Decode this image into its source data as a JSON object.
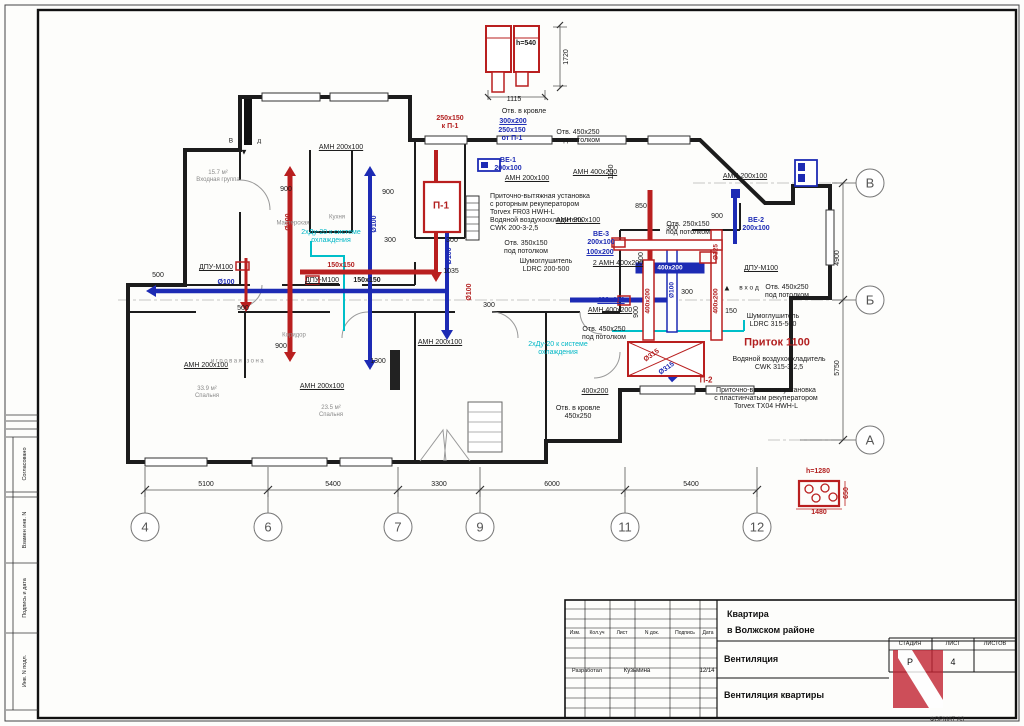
{
  "colors": {
    "black": "#1a1a1a",
    "red": "#b21f1f",
    "blue": "#1d2bb4",
    "cyan": "#00b7c6",
    "gray": "#8a8a8a",
    "white": "#ffffff"
  },
  "sheet": {
    "format_label": "ФОРМАТ А3"
  },
  "stamp_left": [
    {
      "t": "Согласовано",
      "y": 464
    },
    {
      "t": "Взамен инв. N",
      "y": 530
    },
    {
      "t": "Подпись и дата",
      "y": 598
    },
    {
      "t": "Инв. N подл.",
      "y": 671
    }
  ],
  "titleblock": {
    "columns": [
      "Изм.",
      "Кол.уч",
      "Лист",
      "N док.",
      "Подпись",
      "Дата"
    ],
    "row_role": "Разработал",
    "row_name": "Кузьмина",
    "row_date": "12/14",
    "project_line1": "Квартира",
    "project_line2": "в Волжском районе",
    "section": "Вентиляция",
    "drawing": "Вентиляция квартиры",
    "stage_header": "СТАДИЯ",
    "sheet_header": "ЛИСТ",
    "sheets_header": "ЛИСТОВ",
    "stage_value": "Р",
    "sheet_value": "4"
  },
  "axes_bottom": [
    {
      "label": "4",
      "x": 145
    },
    {
      "label": "6",
      "x": 268
    },
    {
      "label": "7",
      "x": 398
    },
    {
      "label": "9",
      "x": 480
    },
    {
      "label": "11",
      "x": 625
    },
    {
      "label": "12",
      "x": 757
    }
  ],
  "axes_right": [
    {
      "label": "В",
      "y": 183
    },
    {
      "label": "Б",
      "y": 300
    },
    {
      "label": "А",
      "y": 440
    }
  ],
  "dims_bottom": [
    {
      "t": "5100",
      "x": 206
    },
    {
      "t": "5400",
      "x": 333
    },
    {
      "t": "3300",
      "x": 439
    },
    {
      "t": "6000",
      "x": 552
    },
    {
      "t": "5400",
      "x": 691
    }
  ],
  "dims_right": [
    {
      "t": "4900",
      "y": 258
    },
    {
      "t": "5750",
      "y": 368
    }
  ],
  "labels": [
    {
      "t": "h=540",
      "x": 526,
      "y": 44,
      "b": 1
    },
    {
      "t": "1720",
      "x": 567,
      "y": 57,
      "r": -90
    },
    {
      "t": "1115",
      "x": 514,
      "y": 100
    },
    {
      "t": "250x150\nк П-1",
      "x": 450,
      "y": 123,
      "c": "red",
      "b": 1
    },
    {
      "t": "Отв. в кровле",
      "x": 524,
      "y": 112
    },
    {
      "t": "300x200",
      "x": 513,
      "y": 122,
      "c": "blue",
      "b": 1,
      "u": 1
    },
    {
      "t": "250x150\nот П-1",
      "x": 512,
      "y": 135,
      "c": "blue",
      "b": 1
    },
    {
      "t": "Отв. 450x250\nпод потолком",
      "x": 578,
      "y": 137
    },
    {
      "t": "АМН 200х100",
      "x": 341,
      "y": 148,
      "u": 1
    },
    {
      "t": "ВЕ-1\n200x100",
      "x": 508,
      "y": 165,
      "c": "blue",
      "b": 1,
      "n": "ve1-label"
    },
    {
      "t": "АМН 200х100",
      "x": 527,
      "y": 179,
      "u": 1
    },
    {
      "t": "АМН 400х200",
      "x": 595,
      "y": 173,
      "u": 1
    },
    {
      "t": "1150",
      "x": 612,
      "y": 172,
      "r": -90
    },
    {
      "t": "Приточно-вытяжная установка\nс роторным рекуператором\nTorvex FR03 HWH-L\nВодяной воздухоохладитель\nCWK 200-3-2,5",
      "x": 540,
      "y": 213,
      "a": "left",
      "n": "ahu1-note"
    },
    {
      "t": "П-1",
      "x": 441,
      "y": 206,
      "c": "red",
      "b": 1,
      "s": 10,
      "n": "unit-p1-label"
    },
    {
      "t": "Отв. 350x150\nпод потолком",
      "x": 526,
      "y": 248
    },
    {
      "t": "Шумоглушитель\nLDRC 200-500",
      "x": 546,
      "y": 266
    },
    {
      "t": "ВЕ-3\n200x100",
      "x": 601,
      "y": 239,
      "c": "blue",
      "b": 1,
      "n": "ve3-label"
    },
    {
      "t": "100x200",
      "x": 600,
      "y": 253,
      "c": "blue",
      "b": 1,
      "u": 1
    },
    {
      "t": "2 АМН 400х200",
      "x": 618,
      "y": 264,
      "u": 1
    },
    {
      "t": "400x100",
      "x": 611,
      "y": 301,
      "c": "blue",
      "b": 1,
      "u": 1
    },
    {
      "t": "АМН 400х200",
      "x": 610,
      "y": 311,
      "u": 1
    },
    {
      "t": "Отв. 450x250\nпод потолком",
      "x": 604,
      "y": 334
    },
    {
      "t": "2хДу-20 к системе\nохлаждения",
      "x": 558,
      "y": 349,
      "c": "cyan"
    },
    {
      "t": "2хДу-20 к системе\nохлаждения",
      "x": 331,
      "y": 237,
      "c": "cyan"
    },
    {
      "t": "АМН 200х100",
      "x": 745,
      "y": 177,
      "u": 1
    },
    {
      "t": "Отв. 250x150\nпод потолком",
      "x": 688,
      "y": 229
    },
    {
      "t": "ВЕ-2\n200x100",
      "x": 756,
      "y": 225,
      "c": "blue",
      "b": 1,
      "n": "ve2-label"
    },
    {
      "t": "ДПУ-М100",
      "x": 761,
      "y": 269,
      "u": 1
    },
    {
      "t": "▲",
      "x": 727,
      "y": 288,
      "s": 8
    },
    {
      "t": "в х о д",
      "x": 749,
      "y": 288,
      "s": 6.5
    },
    {
      "t": "Отв. 450x250\nпод потолком",
      "x": 787,
      "y": 292
    },
    {
      "t": "Шумоглушитель\nLDRC 315-500",
      "x": 773,
      "y": 321
    },
    {
      "t": "Приток 1100",
      "x": 777,
      "y": 343,
      "c": "red",
      "b": 1,
      "s": 11,
      "n": "pritok-label"
    },
    {
      "t": "Водяной воздухоохладитель\nCWK 315-3-2,5",
      "x": 779,
      "y": 364
    },
    {
      "t": "Приточно-вытяжная установка\nс пластинчатым рекуператором\nTorvex TX04 HWH-L",
      "x": 766,
      "y": 399,
      "n": "ahu2-note"
    },
    {
      "t": "400x200",
      "x": 595,
      "y": 392,
      "u": 1
    },
    {
      "t": "Отв. в кровле\n450x250",
      "x": 578,
      "y": 413
    },
    {
      "t": "Ø315",
      "x": 652,
      "y": 356,
      "c": "red",
      "b": 1,
      "r": -35
    },
    {
      "t": "Ø315",
      "x": 667,
      "y": 369,
      "c": "blue",
      "b": 1,
      "r": -35
    },
    {
      "t": "П-2",
      "x": 706,
      "y": 380,
      "c": "red",
      "b": 1,
      "s": 8,
      "n": "unit-p2-label"
    },
    {
      "t": "400x200",
      "x": 670,
      "y": 268,
      "c": "white",
      "b": 1,
      "s": 6.5
    },
    {
      "t": "400x200",
      "x": 648,
      "y": 301,
      "c": "red",
      "b": 1,
      "r": -90,
      "s": 6.5
    },
    {
      "t": "400x200",
      "x": 716,
      "y": 301,
      "c": "red",
      "b": 1,
      "r": -90,
      "s": 6.5
    },
    {
      "t": "Ø125",
      "x": 716,
      "y": 252,
      "c": "red",
      "b": 1,
      "r": -90,
      "s": 6.5
    },
    {
      "t": "Ø100",
      "x": 672,
      "y": 290,
      "c": "blue",
      "b": 1,
      "r": -90,
      "s": 6.5
    },
    {
      "t": "ДПУ-М100",
      "x": 216,
      "y": 268,
      "u": 1
    },
    {
      "t": "ДПУ-М100",
      "x": 322,
      "y": 281,
      "u": 1
    },
    {
      "t": "150x150",
      "x": 341,
      "y": 266,
      "c": "red",
      "b": 1
    },
    {
      "t": "150x150",
      "x": 367,
      "y": 281,
      "b": 1
    },
    {
      "t": "Ø100",
      "x": 226,
      "y": 283,
      "c": "blue",
      "b": 1
    },
    {
      "t": "Ø100",
      "x": 289,
      "y": 222,
      "c": "red",
      "b": 1,
      "r": -90
    },
    {
      "t": "Ø100",
      "x": 375,
      "y": 224,
      "c": "blue",
      "b": 1,
      "r": -90
    },
    {
      "t": "Ø100",
      "x": 450,
      "y": 256,
      "c": "blue",
      "b": 1,
      "r": -90
    },
    {
      "t": "Ø100",
      "x": 470,
      "y": 292,
      "c": "red",
      "b": 1,
      "r": -90
    },
    {
      "t": "АМН 200х100",
      "x": 206,
      "y": 366,
      "u": 1
    },
    {
      "t": "АМН 200х100",
      "x": 322,
      "y": 387,
      "u": 1
    },
    {
      "t": "АМН 200х100",
      "x": 440,
      "y": 343,
      "u": 1
    },
    {
      "t": "АМН 200х100",
      "x": 578,
      "y": 221,
      "u": 1
    },
    {
      "t": "В х о д",
      "x": 246,
      "y": 141,
      "s": 6.5,
      "ls": "2px"
    },
    {
      "t": "▼",
      "x": 244,
      "y": 152,
      "s": 8
    },
    {
      "t": "500",
      "x": 158,
      "y": 276
    },
    {
      "t": "500",
      "x": 243,
      "y": 309
    },
    {
      "t": "900",
      "x": 286,
      "y": 190
    },
    {
      "t": "900",
      "x": 388,
      "y": 193
    },
    {
      "t": "300",
      "x": 390,
      "y": 241
    },
    {
      "t": "300",
      "x": 452,
      "y": 241
    },
    {
      "t": "1035",
      "x": 451,
      "y": 272
    },
    {
      "t": "300",
      "x": 489,
      "y": 306
    },
    {
      "t": "900",
      "x": 281,
      "y": 347
    },
    {
      "t": "1300",
      "x": 378,
      "y": 362
    },
    {
      "t": "850",
      "x": 641,
      "y": 207
    },
    {
      "t": "100",
      "x": 642,
      "y": 258,
      "r": -90
    },
    {
      "t": "900",
      "x": 637,
      "y": 312,
      "r": -90
    },
    {
      "t": "900",
      "x": 717,
      "y": 217
    },
    {
      "t": "300",
      "x": 672,
      "y": 229
    },
    {
      "t": "300",
      "x": 687,
      "y": 293
    },
    {
      "t": "150",
      "x": 731,
      "y": 312
    },
    {
      "t": "15.7 м²\nВходная группа",
      "x": 218,
      "y": 177,
      "c": "gray",
      "s": 6
    },
    {
      "t": "Мастерская",
      "x": 293,
      "y": 224,
      "c": "gray",
      "s": 6
    },
    {
      "t": "Кухня",
      "x": 337,
      "y": 218,
      "c": "gray",
      "s": 6
    },
    {
      "t": "игровая зона",
      "x": 238,
      "y": 362,
      "c": "gray",
      "s": 6,
      "ls": "1.5px"
    },
    {
      "t": "33.9 м²\nСпальня",
      "x": 207,
      "y": 393,
      "c": "gray",
      "s": 6
    },
    {
      "t": "23.5 м²\nСпальня",
      "x": 331,
      "y": 412,
      "c": "gray",
      "s": 6
    },
    {
      "t": "Коридор",
      "x": 294,
      "y": 336,
      "c": "gray",
      "s": 6
    },
    {
      "t": "h=1280",
      "x": 818,
      "y": 472,
      "c": "red",
      "b": 1
    },
    {
      "t": "1480",
      "x": 819,
      "y": 513,
      "c": "red",
      "b": 1
    },
    {
      "t": "650",
      "x": 847,
      "y": 493,
      "c": "red",
      "b": 1,
      "r": -90
    }
  ]
}
